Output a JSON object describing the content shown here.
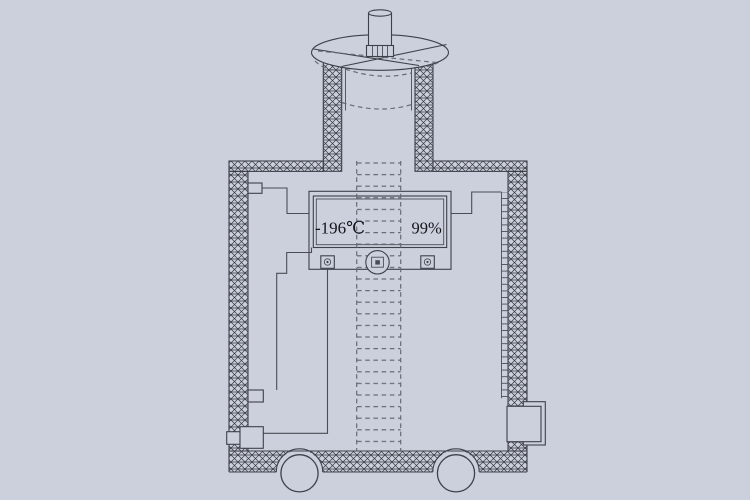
{
  "diagram": {
    "display": {
      "temperature": "-196℃",
      "level": "99%"
    }
  },
  "colors": {
    "background": "#cbd0dc",
    "line": "#3e414a",
    "dashed_line": "#666a74",
    "hatch": "#35383f",
    "text": "#14151a"
  },
  "icons": {
    "screw_left": "screw-icon",
    "screw_right": "screw-icon",
    "shaft_center": "shaft-center-icon"
  }
}
